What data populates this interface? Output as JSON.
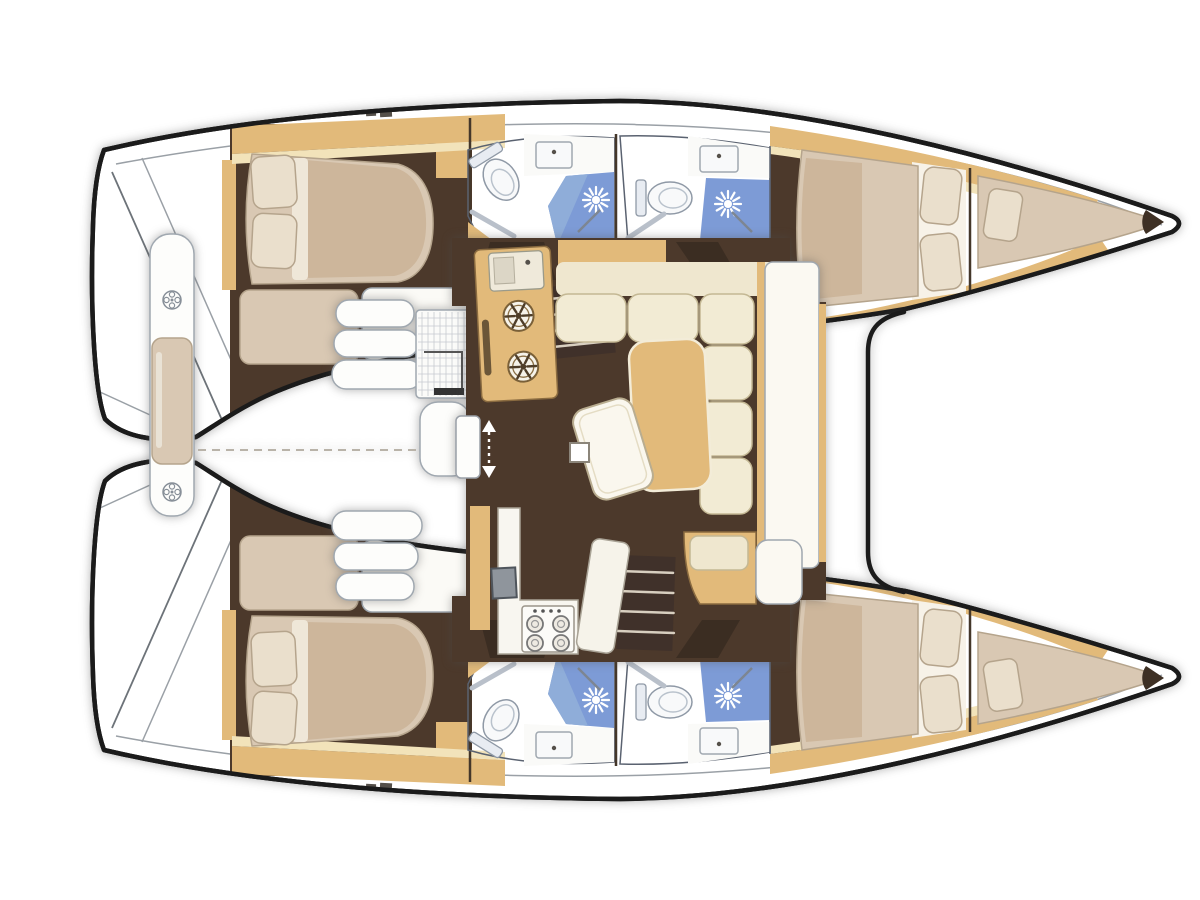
{
  "diagram": {
    "type": "floor-plan",
    "subject": "catamaran yacht interior deck plan, bows to the right: 4 double cabins, 4 bathrooms with shower and toilet, central saloon with galley, sofa and table, 2 forepeak berths, aft cockpit bench",
    "canvas": {
      "width": 1200,
      "height": 900
    },
    "colors": {
      "background": "#ffffff",
      "hull_white": "#ffffff",
      "outline": "#1b1b1b",
      "floor": "#4c392b",
      "wood": "#e2ba7a",
      "wood_light": "#f2e3ba",
      "cream_panel": "#efe7cf",
      "sofa_cushion": "#f2ebd4",
      "white_soft": "#fbf9f2",
      "mattress": "#d9c8b3",
      "duvet": "#cdb69b",
      "pillow": "#eadfcc",
      "bath_floor": "#b3c4e6",
      "bath_shower": "#7d9bd6",
      "fixture_white": "#f8f9fa",
      "counter_white": "#f8f6f0",
      "appliance_grey": "#8f959c",
      "step_dark": "#40312a",
      "threshold_dark": "#3b2d22",
      "tip_dark": "#3e3024",
      "deck_mark": "#55504a"
    },
    "rooms": {
      "port_hull": [
        "aft-cabin",
        "aft-bathroom",
        "forward-bathroom",
        "forward-cabin",
        "forepeak-berth"
      ],
      "starboard_hull": [
        "aft-cabin",
        "aft-bathroom",
        "forward-bathroom",
        "forward-cabin",
        "forepeak-berth"
      ],
      "center": [
        "saloon",
        "galley",
        "cockpit"
      ]
    },
    "fixtures": {
      "toilets": 4,
      "showers": 4,
      "bathroom_sinks": 4,
      "galley_hob_burners": 2,
      "stove_burners": 4,
      "double_beds": 4,
      "forepeak_berths": 2,
      "companionway_steps": 2,
      "sliding_doors": 1,
      "saloon_tables": 1,
      "cockpit_benches": 1
    }
  }
}
